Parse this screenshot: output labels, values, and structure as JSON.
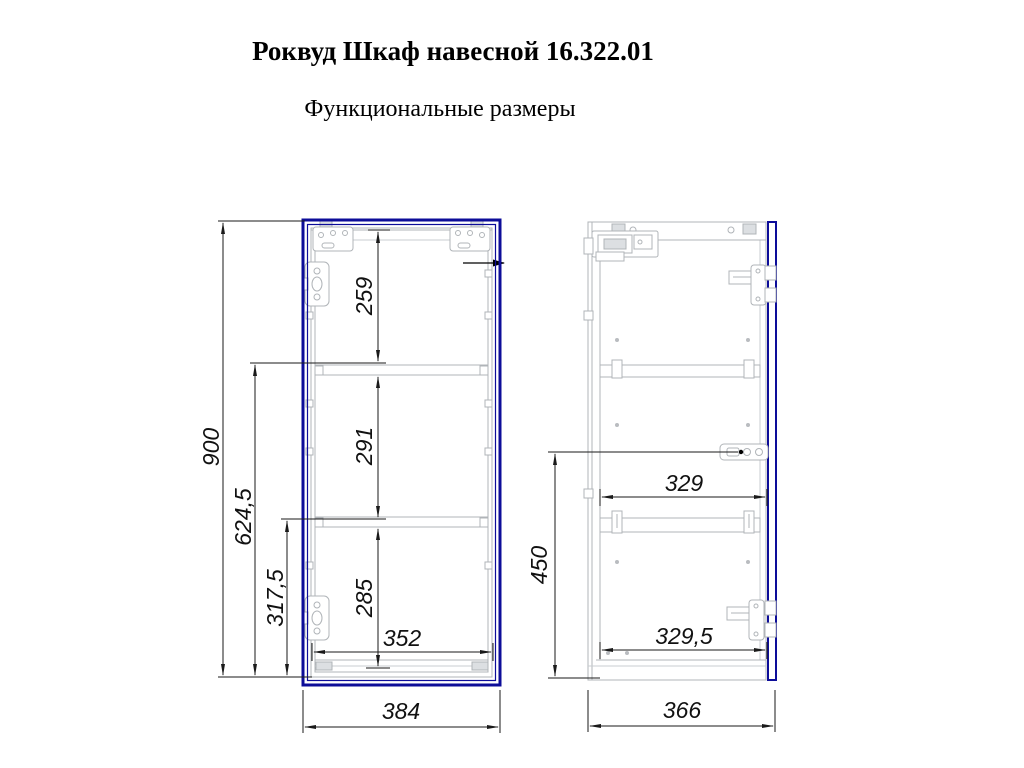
{
  "title": "Роквуд Шкаф навесной 16.322.01",
  "subtitle": "Функциональные размеры",
  "colors": {
    "door_outline": "#0d0d99",
    "carcass_line": "#b0b4b8",
    "dimension_line": "#1a1a1a"
  },
  "front_view": {
    "dims": {
      "overall_height": "900",
      "upper_shelf_to_bottom": "624,5",
      "lower_shelf_to_bottom": "317,5",
      "top_compartment_height": "259",
      "middle_compartment_height": "291",
      "bottom_compartment_height": "285",
      "inner_width": "352",
      "overall_width": "384"
    }
  },
  "side_view": {
    "dims": {
      "upper_inner_depth": "329",
      "lower_inner_depth": "329,5",
      "overall_depth": "366",
      "lower_section_height": "450"
    }
  }
}
